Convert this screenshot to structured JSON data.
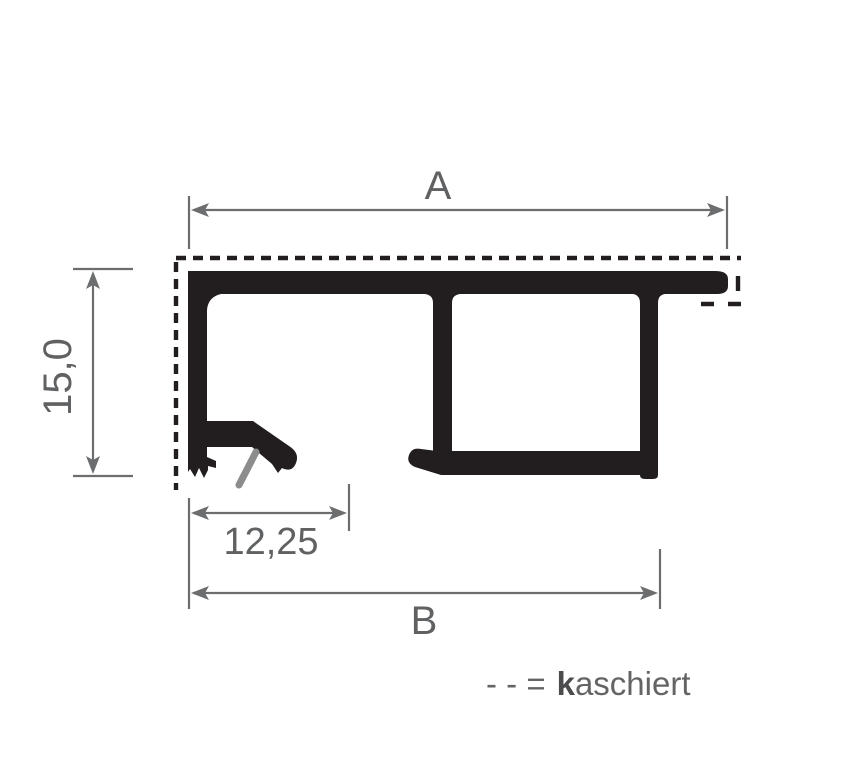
{
  "drawing": {
    "type": "profile-cross-section-diagram",
    "dimension_labels": {
      "width_top": "A",
      "height_left": "15,0",
      "clip_offset": "12,25",
      "width_bottom": "B"
    },
    "legend": {
      "symbol": "- - =",
      "term_bold": "k",
      "term_rest": "aschiert"
    },
    "colors": {
      "profile_black": "#221e1f",
      "dimension_gray": "#6b6d6f",
      "label_gray": "#5f6163",
      "clip_pin_gray": "#8c8c8c",
      "background": "#ffffff"
    }
  }
}
